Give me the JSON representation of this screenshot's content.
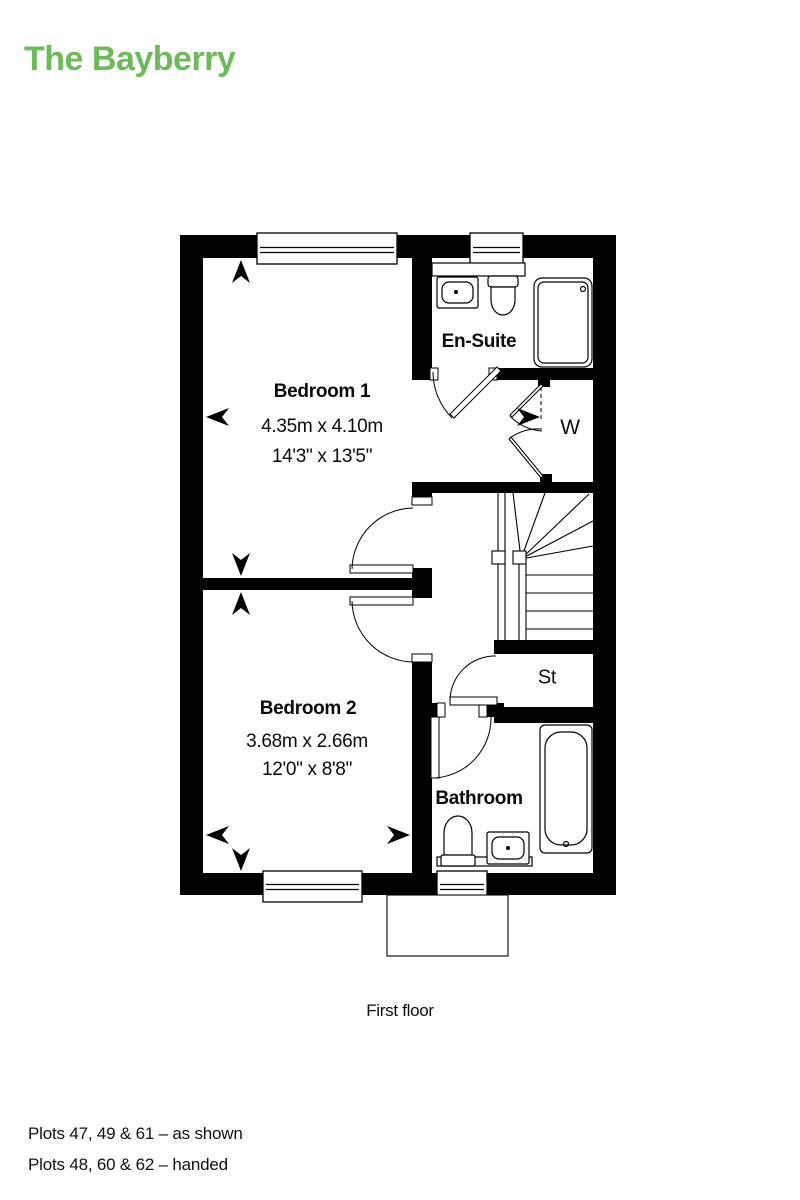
{
  "title": "The Bayberry",
  "floor": {
    "label": "First floor"
  },
  "plots": {
    "as_shown": "Plots 47, 49 & 61 – as shown",
    "handed": "Plots 48, 60 & 62 – handed"
  },
  "rooms": {
    "bedroom1": {
      "name": "Bedroom 1",
      "metric": "4.35m x 4.10m",
      "imperial": "14'3\" x 13'5\""
    },
    "bedroom2": {
      "name": "Bedroom 2",
      "metric": "3.68m x 2.66m",
      "imperial": "12'0\" x 8'8\""
    },
    "ensuite": {
      "name": "En-Suite"
    },
    "bathroom": {
      "name": "Bathroom"
    },
    "wardrobe": {
      "abbr": "W"
    },
    "store": {
      "abbr": "St"
    }
  },
  "colors": {
    "accent": "#6CBA5A",
    "line": "#000000"
  }
}
